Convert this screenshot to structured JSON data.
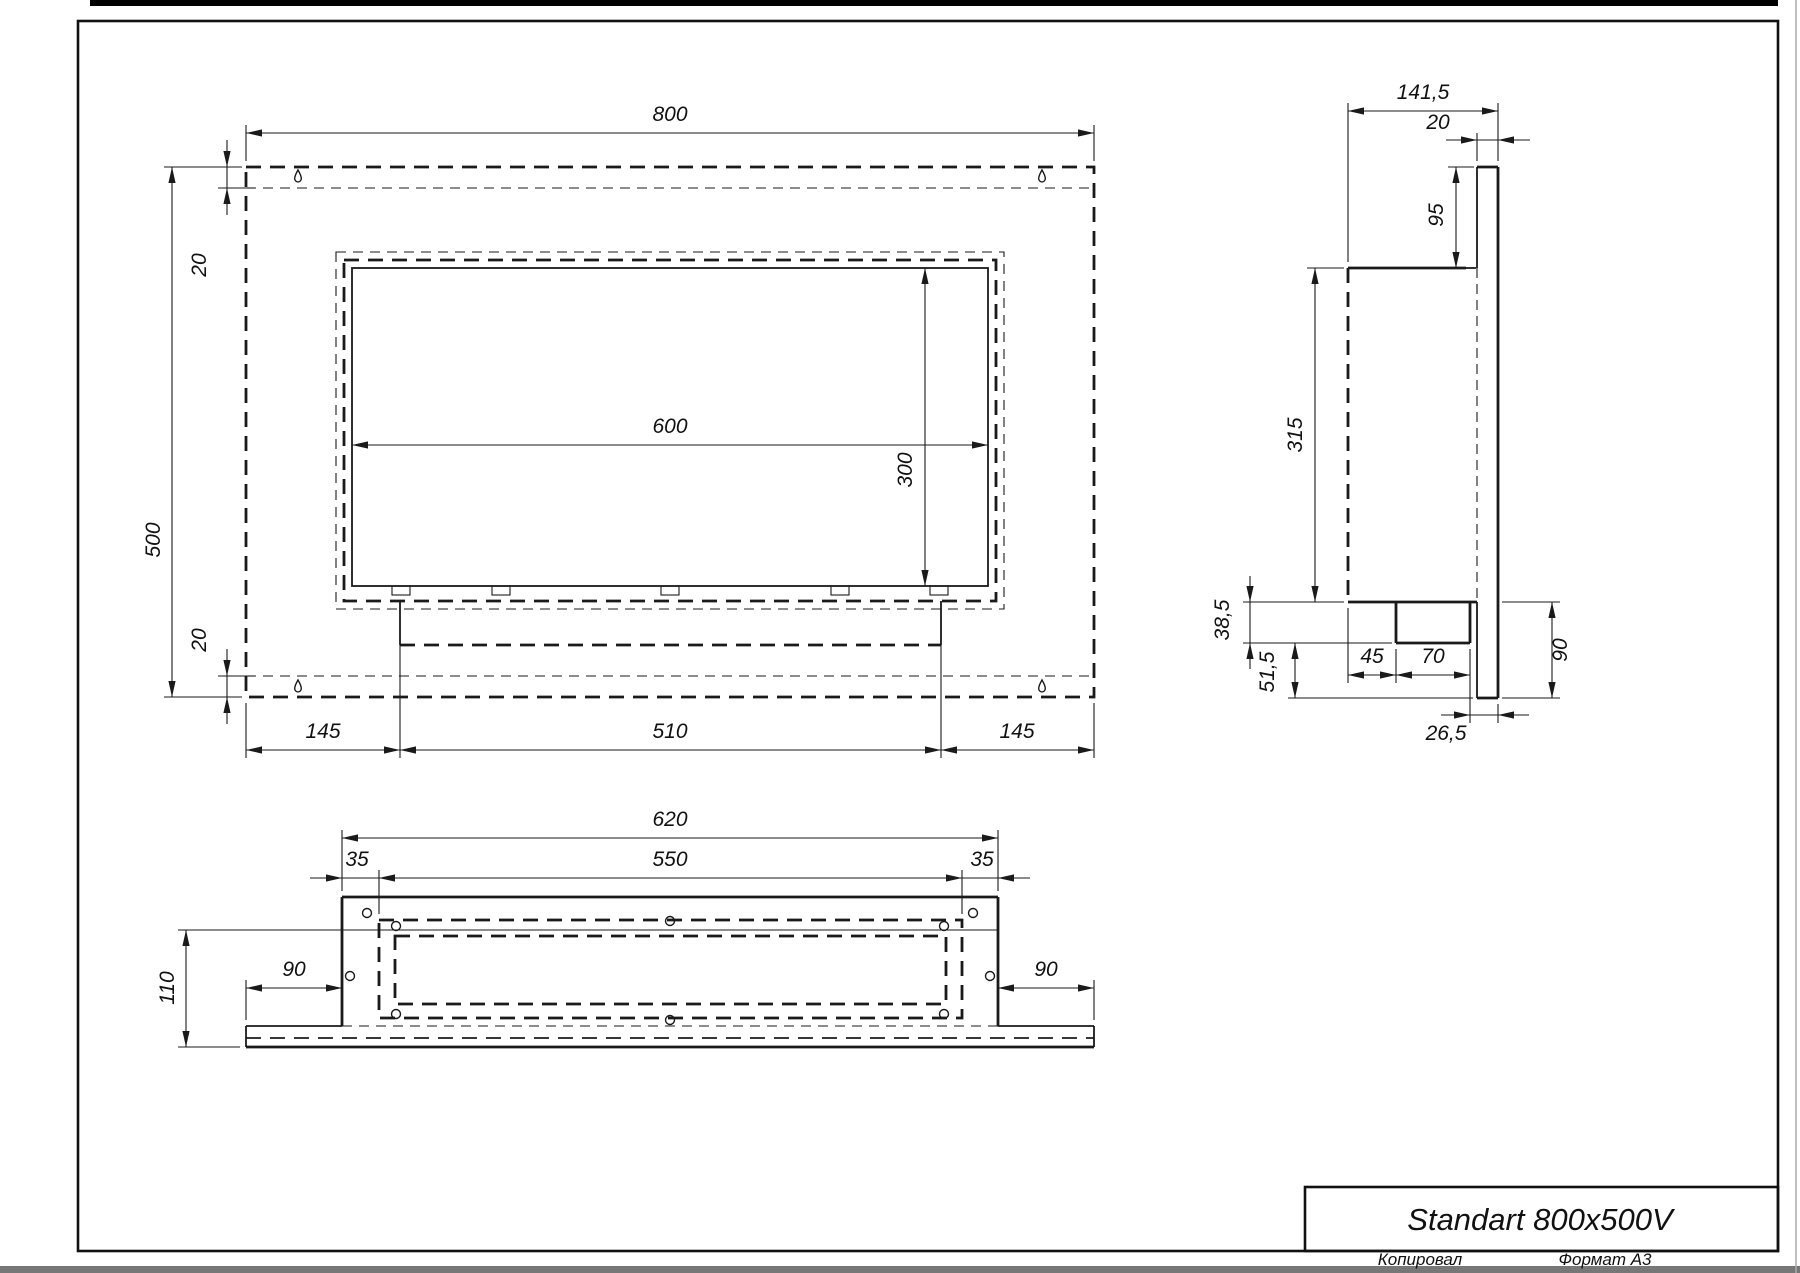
{
  "title": {
    "name": "Standart 800x500V",
    "copied": "Копировал",
    "format": "Формат А3"
  },
  "front": {
    "width": "800",
    "height": "500",
    "margin_top": "20",
    "margin_bottom": "20",
    "opening_width": "600",
    "opening_height": "300",
    "bottom_left": "145",
    "bottom_center": "510",
    "bottom_right": "145"
  },
  "side": {
    "depth": "141,5",
    "plate_thickness": "20",
    "top_offset": "95",
    "body_height": "315",
    "burner_height": "38,5",
    "lower_offset": "51,5",
    "burner_left_offset": "45",
    "burner_width": "70",
    "back_offset": "26,5",
    "lower_total": "90"
  },
  "plan": {
    "body_width": "620",
    "opening_width": "550",
    "margin_left": "35",
    "margin_right": "35",
    "depth": "110",
    "plate_left": "90",
    "plate_right": "90"
  }
}
